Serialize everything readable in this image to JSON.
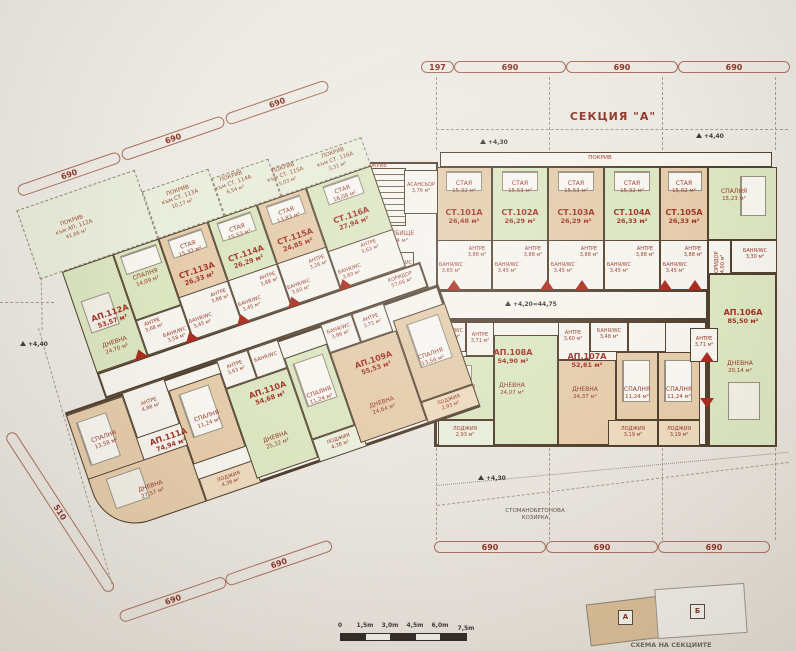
{
  "title": {
    "section": "СЕКЦИЯ \"А\""
  },
  "labels": {
    "pokriv": "ПОКРИВ",
    "koridor": "КОРИДОР",
    "stair": "СТЪЛБИЩЕ",
    "elevator": "АСАНСЬОР",
    "kamer_office": "КАМЕР. ОФИС",
    "ausgus": "АУСГУС",
    "canopy_line1": "СТОМАНОБЕТОНОВА",
    "canopy_line2": "КОЗИРКА",
    "schema_caption": "СХЕМА НА СЕКЦИИТЕ",
    "schema_a": "А",
    "schema_b": "Б",
    "staya": "СТАЯ",
    "antre": "АНТРЕ",
    "bath": "БАНЯ/WC",
    "bedroom": "СПАЛНЯ",
    "living": "ДНЕВНА",
    "loggia": "ЛОДЖИЯ"
  },
  "areas": {
    "koridor_left": "57,66 м²",
    "stair": "17,54 м²",
    "elevator": "3,76 м²",
    "kamer_office": "3,03 м²",
    "ausgus": "4,00 м²",
    "bath_core": "3,86 м²"
  },
  "elevations": {
    "e430": "+4,30",
    "e440": "+4,40",
    "corridor": "+4,20=44,75"
  },
  "dims": {
    "top": [
      "197",
      "690",
      "690",
      "690"
    ],
    "bottom": [
      "690",
      "690",
      "690"
    ],
    "upper_left": [
      "690",
      "690",
      "690"
    ],
    "lower_left": [
      "690",
      "690"
    ],
    "side": "510"
  },
  "scalebar": {
    "ticks": [
      "0",
      "1,5m",
      "3,0m",
      "4,5m",
      "6,0m",
      "7,5m"
    ]
  },
  "roofs": [
    {
      "name": "ПОКРИВ",
      "sub": "към АП. 112А",
      "area": "41,66 м²"
    },
    {
      "name": "ПОКРИВ",
      "sub": "към СТ. 113А",
      "area": "10,17 м²"
    },
    {
      "name": "ПОКРИВ",
      "sub": "към СТ. 114А",
      "area": "6,54 м²"
    },
    {
      "name": "ПОКРИВ",
      "sub": "към СТ. 115А",
      "area": "5,03 м²"
    },
    {
      "name": "ПОКРИВ",
      "sub": "към СТ. 116А",
      "area": "3,31 м²"
    }
  ],
  "units": {
    "st101": {
      "id": "СТ.101А",
      "area": "26,48 м²",
      "staya": "15,32 м²",
      "antre": "3,88 м²",
      "bath": "3,65 м²"
    },
    "st102": {
      "id": "СТ.102А",
      "area": "26,29 м²",
      "staya": "15,53 м²",
      "antre": "3,88 м²",
      "bath": "3,45 м²"
    },
    "st103": {
      "id": "СТ.103А",
      "area": "26,29 м²",
      "staya": "15,53 м²",
      "antre": "3,88 м²",
      "bath": "3,45 м²"
    },
    "st104": {
      "id": "СТ.104А",
      "area": "26,33 м²",
      "staya": "15,32 м²",
      "antre": "3,88 м²",
      "bath": "3,45 м²"
    },
    "st105": {
      "id": "СТ.105А",
      "area": "26,33 м²",
      "staya": "15,02 м²",
      "antre": "3,88 м²",
      "bath": "3,45 м²"
    },
    "ap106": {
      "id": "АП.106А",
      "area": "85,50 м²",
      "bedroom1": "15,23 м²",
      "bedroom2": "11,24 м²",
      "living": "20,14 м²",
      "antre": "3,71 м²",
      "bath": "3,30 м²",
      "loggia": "3,19 м²",
      "koridor": "4,00 м²"
    },
    "ap107": {
      "id": "АП.107А",
      "area": "52,61 м²",
      "living": "24,37 м²",
      "bedroom": "11,24 м²",
      "antre": "3,60 м²",
      "bath": "3,48 м²",
      "loggia": "3,19 м²"
    },
    "ap108": {
      "id": "АП.108А",
      "area": "54,90 м²",
      "living": "24,07 м²",
      "bedroom": "13,29 м²",
      "antre": "3,71 м²",
      "bath": "3,45 м²",
      "loggia": "2,93 м²"
    },
    "ap109": {
      "id": "АП.109А",
      "area": "55,53 м²",
      "living": "24,64 м²",
      "bedroom": "13,56 м²",
      "antre": "3,71 м²",
      "bath": "3,96 м²",
      "loggia": "2,93 м²"
    },
    "ap110": {
      "id": "АП.110А",
      "area": "54,68 м²",
      "living": "25,32 м²",
      "bedroom": "11,24 м²",
      "antre": "3,63 м²",
      "loggia": "4,38 м²"
    },
    "ap111": {
      "id": "АП.111А",
      "area": "74,94 м²",
      "living": "27,57 м²",
      "bedroom1": "13,58 м²",
      "bedroom2": "11,24 м²",
      "antre": "4,88 м²",
      "loggia": "4,38 м²"
    },
    "ap112": {
      "id": "АП.112А",
      "area": "53,57 м²",
      "living": "24,70 м²",
      "bedroom": "14,09 м²",
      "antre": "3,68 м²",
      "bath": "3,58 м²"
    },
    "st113": {
      "id": "СТ.113А",
      "area": "26,33 м²",
      "staya": "15,32 м²",
      "antre": "3,88 м²",
      "bath": "3,45 м²"
    },
    "st114": {
      "id": "СТ.114А",
      "area": "26,29 м²",
      "staya": "15,53 м²",
      "antre": "3,88 м²",
      "bath": "3,45 м²"
    },
    "st115": {
      "id": "СТ.115А",
      "area": "24,85 м²",
      "staya": "13,83 м²",
      "antre": "3,26 м²",
      "bath": "3,60 м²"
    },
    "st116": {
      "id": "СТ.116А",
      "area": "27,94 м²",
      "staya": "16,08 м²",
      "antre": "3,63 м²",
      "bath": "3,60 м²"
    }
  },
  "colors": {
    "wall": "#52402e",
    "tan": "#e4cbaa",
    "green": "#dbe5c0",
    "paper": "#eae7e1",
    "accent": "#963726",
    "marker": "#a92b1d"
  }
}
